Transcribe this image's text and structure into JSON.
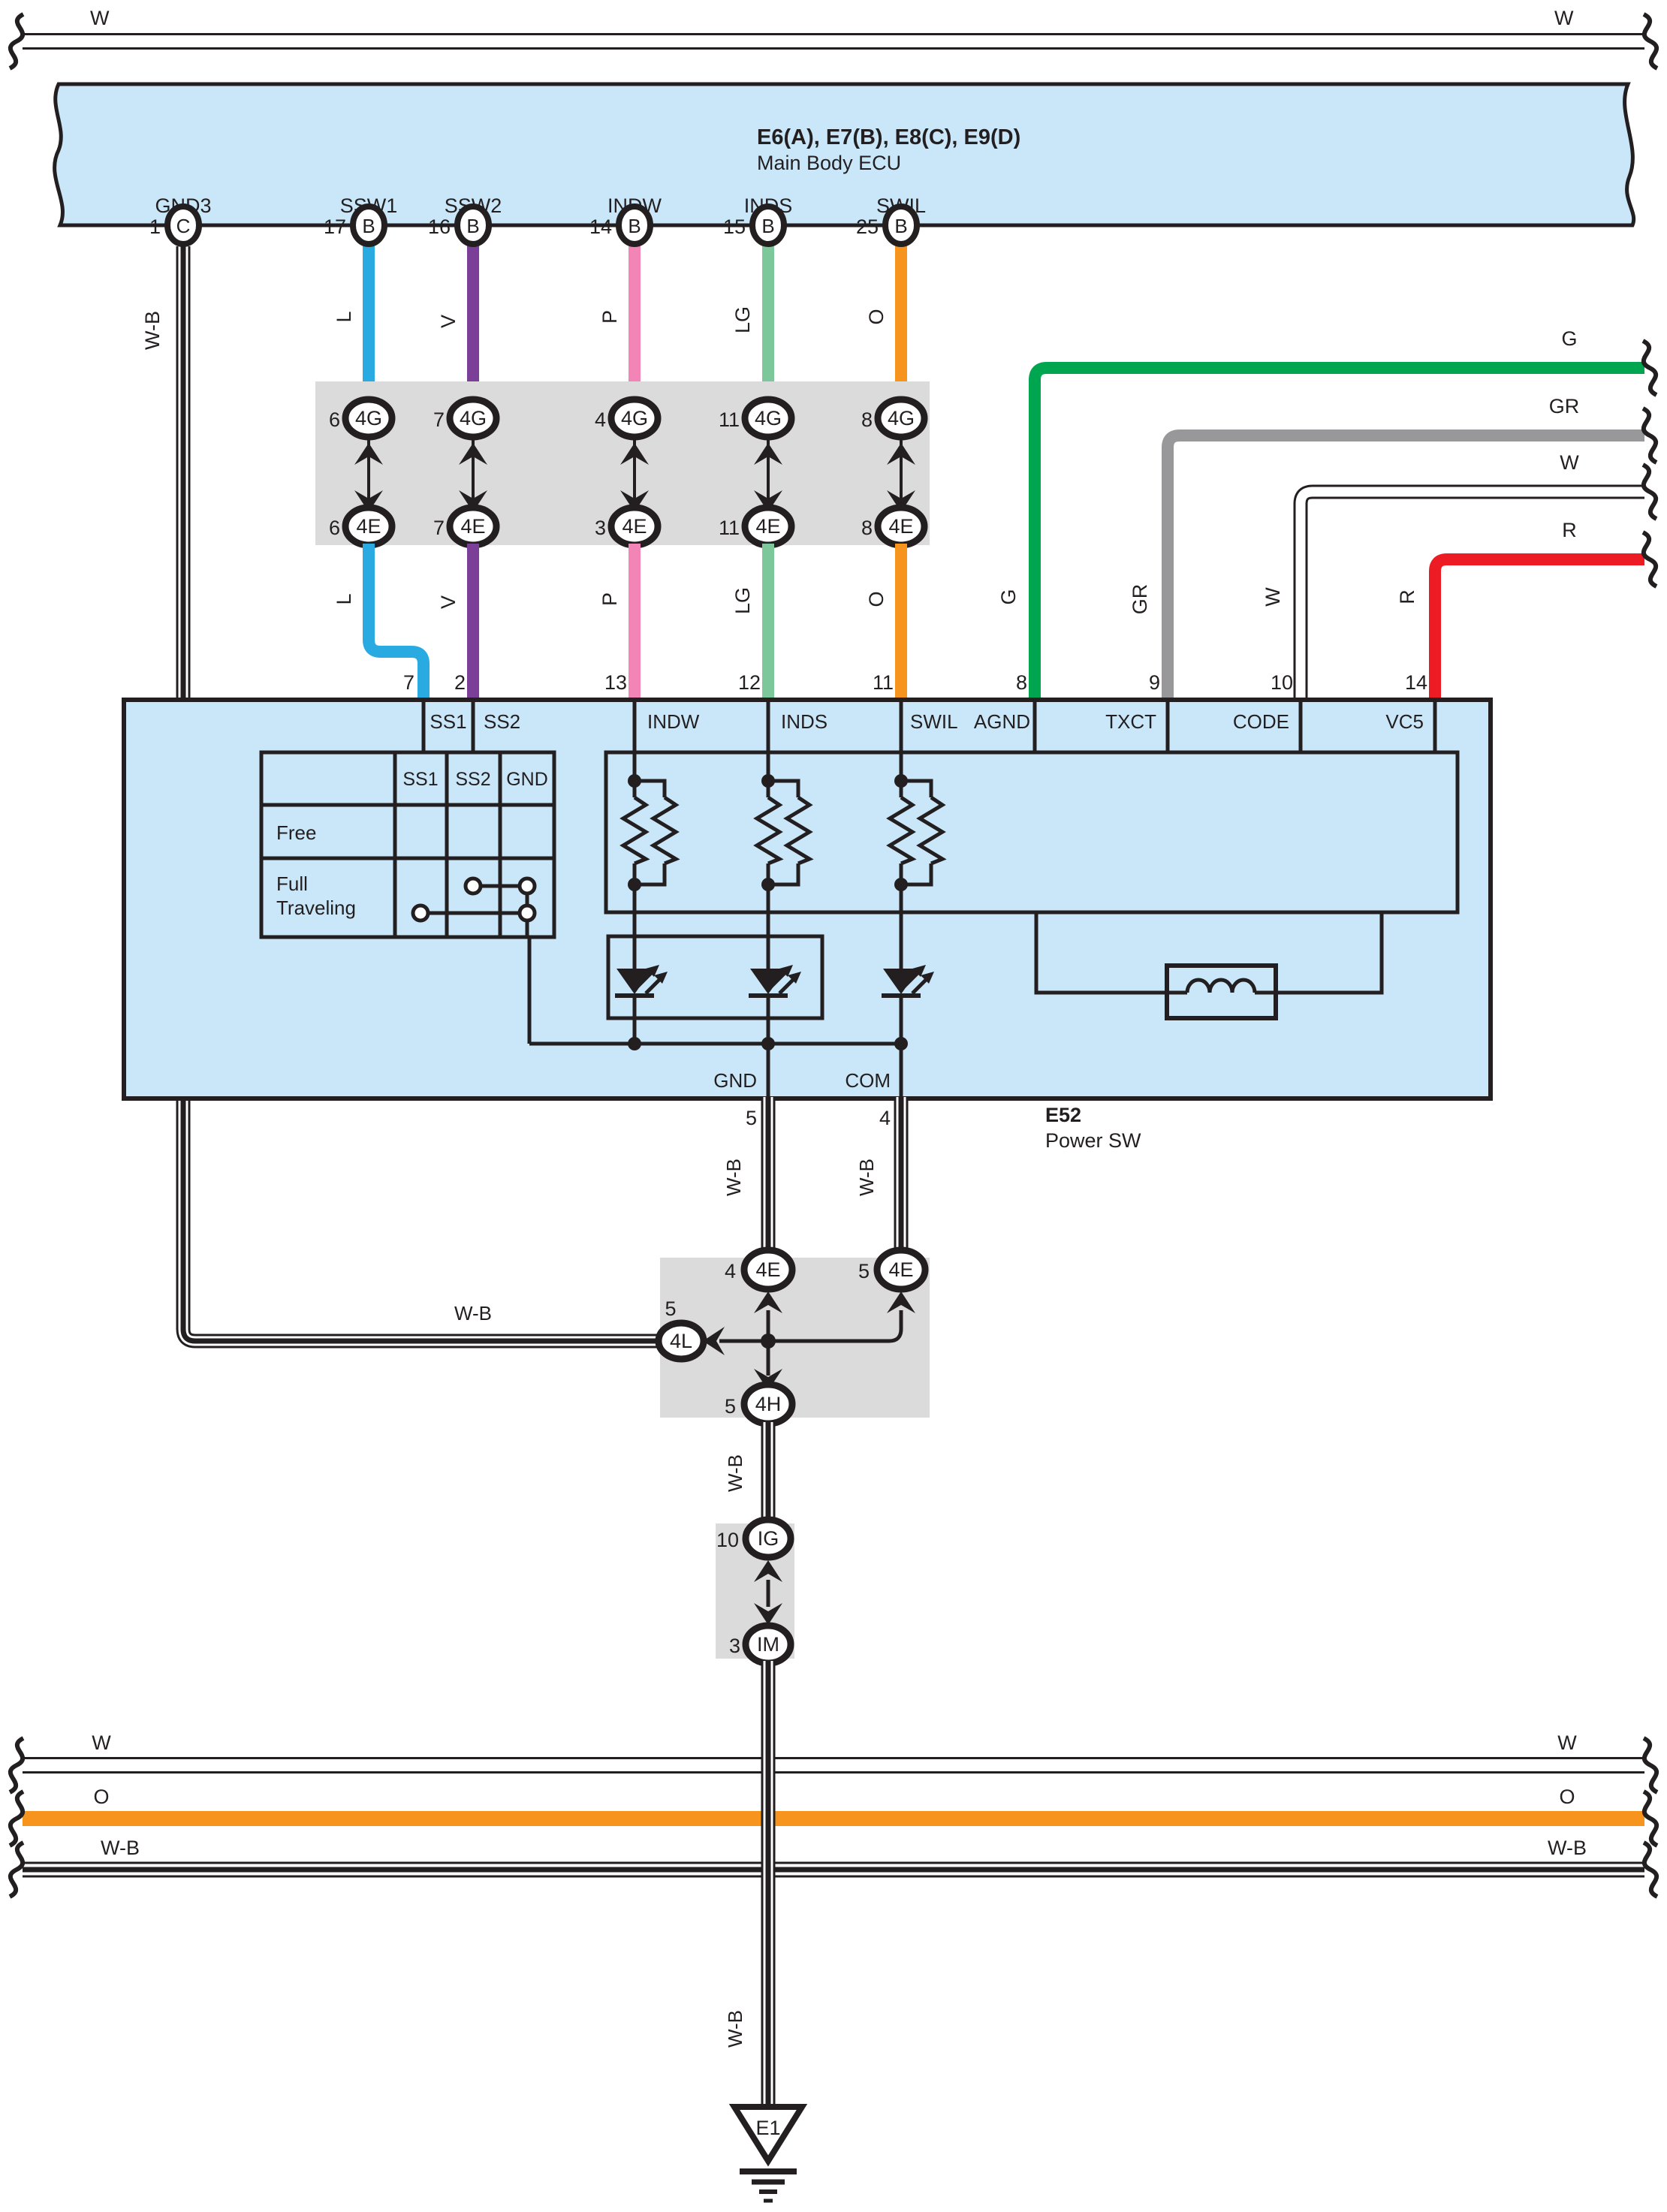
{
  "top_bus": {
    "left": "W",
    "right": "W"
  },
  "ecu": {
    "title": "E6(A), E7(B), E8(C), E9(D)",
    "subtitle": "Main Body ECU",
    "pins": [
      {
        "name": "GND3",
        "num": "1",
        "conn": "C",
        "wire": "W-B"
      },
      {
        "name": "SSW1",
        "num": "17",
        "conn": "B",
        "wire": "L"
      },
      {
        "name": "SSW2",
        "num": "16",
        "conn": "B",
        "wire": "V"
      },
      {
        "name": "INDW",
        "num": "14",
        "conn": "B",
        "wire": "P"
      },
      {
        "name": "INDS",
        "num": "15",
        "conn": "B",
        "wire": "LG"
      },
      {
        "name": "SWIL",
        "num": "25",
        "conn": "B",
        "wire": "O"
      }
    ]
  },
  "junction1": {
    "cols": [
      {
        "wire": "L",
        "g_num": "6",
        "g": "4G",
        "e_num": "6",
        "e": "4E"
      },
      {
        "wire": "V",
        "g_num": "7",
        "g": "4G",
        "e_num": "7",
        "e": "4E"
      },
      {
        "wire": "P",
        "g_num": "4",
        "g": "4G",
        "e_num": "3",
        "e": "4E"
      },
      {
        "wire": "LG",
        "g_num": "11",
        "g": "4G",
        "e_num": "11",
        "e": "4E"
      },
      {
        "wire": "O",
        "g_num": "8",
        "g": "4G",
        "e_num": "8",
        "e": "4E"
      }
    ]
  },
  "right_wires": [
    {
      "label": "G"
    },
    {
      "label": "GR"
    },
    {
      "label": "W"
    },
    {
      "label": "R"
    }
  ],
  "power_sw": {
    "id": "E52",
    "name": "Power SW",
    "pins": [
      {
        "name": "SS1",
        "num": "7"
      },
      {
        "name": "SS2",
        "num": "2"
      },
      {
        "name": "INDW",
        "num": "13"
      },
      {
        "name": "INDS",
        "num": "12"
      },
      {
        "name": "SWIL",
        "num": "11"
      },
      {
        "name": "AGND",
        "num": "8"
      },
      {
        "name": "TXCT",
        "num": "9"
      },
      {
        "name": "CODE",
        "num": "10"
      },
      {
        "name": "VC5",
        "num": "14"
      }
    ],
    "table": {
      "headers": [
        "SS1",
        "SS2",
        "GND"
      ],
      "row1": "Free",
      "row2_line1": "Full",
      "row2_line2": "Traveling"
    },
    "bottom_pins": [
      {
        "name": "GND",
        "num": "5",
        "wire": "W-B"
      },
      {
        "name": "COM",
        "num": "4",
        "wire": "W-B"
      }
    ]
  },
  "junction2": {
    "left_conn": {
      "num": "4",
      "label": "4E"
    },
    "right_conn": {
      "num": "5",
      "label": "4E"
    },
    "side_conn": {
      "num": "5",
      "label": "4L"
    },
    "bottom_conn": {
      "num": "5",
      "label": "4H"
    },
    "wire_in": "W-B",
    "wire_out": "W-B"
  },
  "junction3": {
    "top_conn": {
      "num": "10",
      "label": "IG"
    },
    "bottom_conn": {
      "num": "3",
      "label": "IM"
    }
  },
  "bottom_buses": [
    {
      "left": "W",
      "right": "W"
    },
    {
      "left": "O",
      "right": "O"
    },
    {
      "left": "W-B",
      "right": "W-B"
    }
  ],
  "ground": {
    "id": "E1",
    "wire": "W-B"
  },
  "colors": {
    "l": "#29ABE2",
    "v": "#7B3F98",
    "p": "#F285B5",
    "lg": "#7CC89B",
    "o": "#F7941E",
    "g": "#00A550",
    "gr": "#98989A",
    "r": "#EC1B24",
    "boxfill": "#C9E7F9",
    "blockfill": "#DBDBDB",
    "line": "#231F20"
  }
}
